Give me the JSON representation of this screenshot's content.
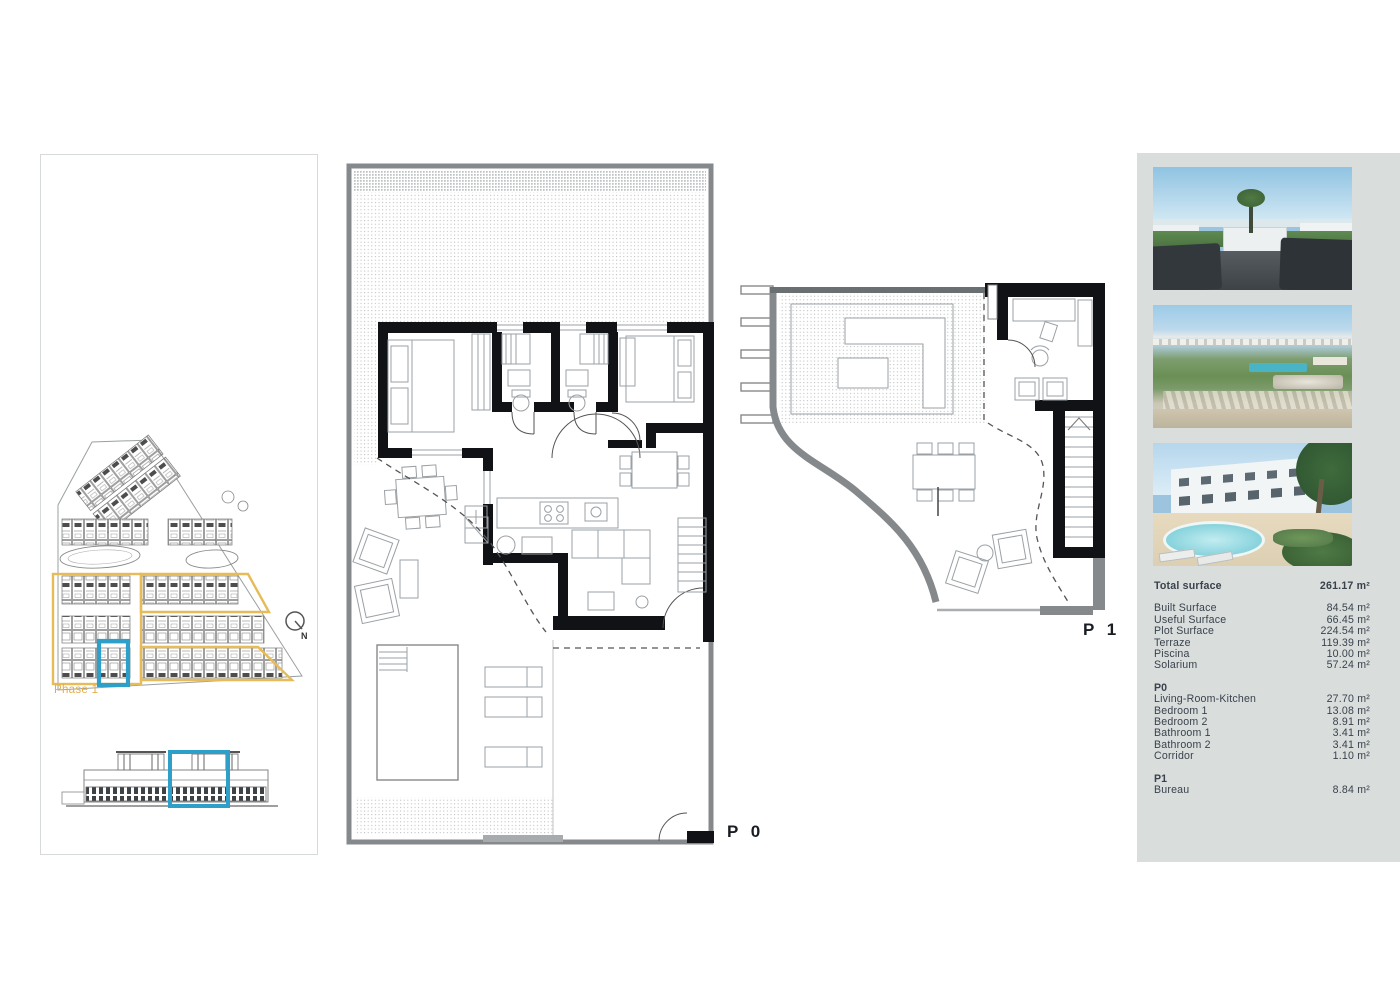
{
  "page": {
    "type": "real-estate floor plan sheet"
  },
  "labels": {
    "p0": "P 0",
    "p1": "P 1"
  },
  "site_plan": {
    "phase_label": "Phase 1",
    "north_label": "N"
  },
  "right_panel": {
    "photos": [
      "rooftop-terrace-render",
      "aerial-coast-view",
      "residences-pool-render"
    ]
  },
  "surface_table": {
    "total": {
      "label": "Total surface",
      "value": "261.17 m²"
    },
    "general_rows": [
      {
        "label": "Built Surface",
        "value": "84.54 m²"
      },
      {
        "label": "Useful Surface",
        "value": "66.45 m²"
      },
      {
        "label": "Plot Surface",
        "value": "224.54 m²"
      },
      {
        "label": "Terraze",
        "value": "119.39 m²"
      },
      {
        "label": "Piscina",
        "value": "10.00 m²"
      },
      {
        "label": "Solarium",
        "value": "57.24 m²"
      }
    ],
    "p0_section": {
      "header": "P0",
      "rows": [
        {
          "label": "Living-Room-Kitchen",
          "value": "27.70 m²"
        },
        {
          "label": "Bedroom 1",
          "value": "13.08 m²"
        },
        {
          "label": "Bedroom 2",
          "value": "8.91 m²"
        },
        {
          "label": "Bathroom 1",
          "value": "3.41 m²"
        },
        {
          "label": "Bathroom 2",
          "value": "3.41 m²"
        },
        {
          "label": "Corridor",
          "value": "1.10 m²"
        }
      ]
    },
    "p1_section": {
      "header": "P1",
      "rows": [
        {
          "label": "Bureau",
          "value": "8.84 m²"
        }
      ]
    }
  },
  "colors": {
    "accent_blue": "#2d9fc8",
    "accent_yellow": "#e6bb58",
    "panel_bg": "#d9dddc",
    "text": "#39424c"
  }
}
